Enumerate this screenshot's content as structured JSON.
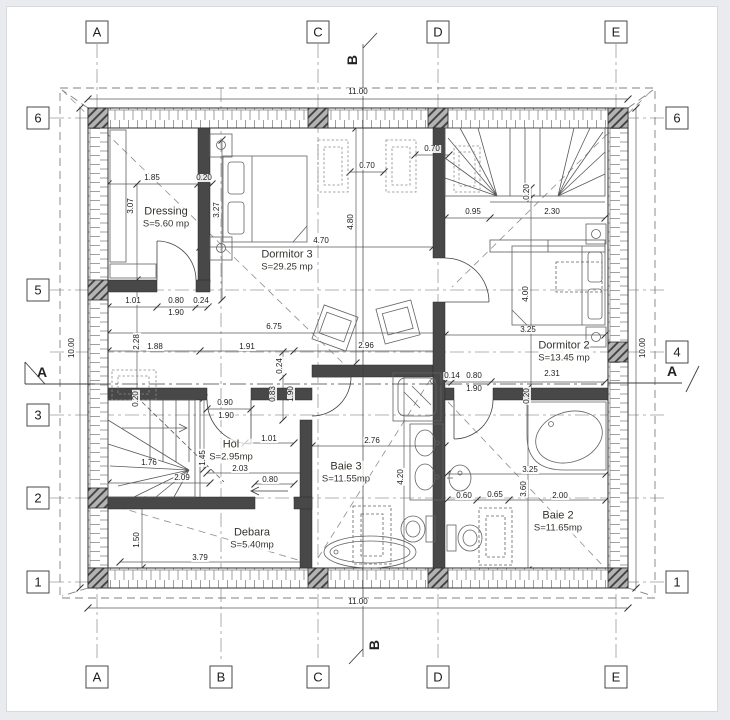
{
  "drawing": {
    "type": "floor-plan",
    "colors": {
      "paper": "#ffffff",
      "line": "#3a3a3a",
      "wall_fill": "#484848",
      "hatch": "#777777",
      "grid": "#9a9aa0"
    }
  },
  "axes": {
    "top": [
      {
        "label": "A",
        "x": 97
      },
      {
        "label": "C",
        "x": 318
      },
      {
        "label": "D",
        "x": 438
      },
      {
        "label": "E",
        "x": 616
      }
    ],
    "bottom": [
      {
        "label": "A",
        "x": 97
      },
      {
        "label": "B",
        "x": 221
      },
      {
        "label": "C",
        "x": 318
      },
      {
        "label": "D",
        "x": 438
      },
      {
        "label": "E",
        "x": 616
      }
    ],
    "left": [
      {
        "label": "6",
        "y": 118
      },
      {
        "label": "5",
        "y": 290
      },
      {
        "label": "3",
        "y": 415
      },
      {
        "label": "2",
        "y": 498
      },
      {
        "label": "1",
        "y": 582
      }
    ],
    "right": [
      {
        "label": "6",
        "y": 118
      },
      {
        "label": "4",
        "y": 352
      },
      {
        "label": "1",
        "y": 582
      }
    ],
    "sections": [
      {
        "label": "A",
        "x": 42,
        "y": 372
      },
      {
        "label": "A",
        "x": 672,
        "y": 371
      },
      {
        "label": "B",
        "x": 352,
        "y": 60,
        "r": 1
      },
      {
        "label": "B",
        "x": 374,
        "y": 645,
        "r": 1
      }
    ]
  },
  "rooms": [
    {
      "name": "Dressing",
      "area": "S=5.60 mp",
      "x": 166,
      "y": 218
    },
    {
      "name": "Dormitor 3",
      "area": "S=29.25 mp",
      "x": 287,
      "y": 261
    },
    {
      "name": "Dormitor 2",
      "area": "S=13.45 mp",
      "x": 564,
      "y": 352
    },
    {
      "name": "Hol",
      "area": "S=2.95mp",
      "x": 231,
      "y": 451
    },
    {
      "name": "Baie 3",
      "area": "S=11.55mp",
      "x": 346,
      "y": 473
    },
    {
      "name": "Debara",
      "area": "S=5.40mp",
      "x": 252,
      "y": 539
    },
    {
      "name": "Baie 2",
      "area": "S=11.65mp",
      "x": 558,
      "y": 522
    }
  ],
  "dims": [
    {
      "t": "11.00",
      "x": 358,
      "y": 92
    },
    {
      "t": "11.00",
      "x": 358,
      "y": 602
    },
    {
      "t": "10.00",
      "x": 72,
      "y": 348,
      "r": 1
    },
    {
      "t": "10.00",
      "x": 643,
      "y": 348,
      "r": 1
    },
    {
      "t": "1.85",
      "x": 152,
      "y": 178
    },
    {
      "t": "0.20",
      "x": 204,
      "y": 178
    },
    {
      "t": "3.07",
      "x": 131,
      "y": 206,
      "r": 1
    },
    {
      "t": "3.27",
      "x": 217,
      "y": 210,
      "r": 1
    },
    {
      "t": "0.70",
      "x": 367,
      "y": 166
    },
    {
      "t": "0.70",
      "x": 432,
      "y": 149
    },
    {
      "t": "4.80",
      "x": 351,
      "y": 222,
      "r": 1
    },
    {
      "t": "4.70",
      "x": 321,
      "y": 241
    },
    {
      "t": "0.95",
      "x": 473,
      "y": 212
    },
    {
      "t": "2.30",
      "x": 552,
      "y": 212
    },
    {
      "t": "0.20",
      "x": 527,
      "y": 192,
      "r": 1
    },
    {
      "t": "4.00",
      "x": 526,
      "y": 294,
      "r": 1
    },
    {
      "t": "3.25",
      "x": 528,
      "y": 330
    },
    {
      "t": "0.14",
      "x": 452,
      "y": 376
    },
    {
      "t": "0.80",
      "x": 474,
      "y": 376
    },
    {
      "t": "2.31",
      "x": 552,
      "y": 374
    },
    {
      "t": "1.90",
      "x": 474,
      "y": 389
    },
    {
      "t": "0.20",
      "x": 527,
      "y": 396,
      "r": 1
    },
    {
      "t": "1.01",
      "x": 133,
      "y": 301
    },
    {
      "t": "0.80",
      "x": 176,
      "y": 301
    },
    {
      "t": "0.24",
      "x": 201,
      "y": 301
    },
    {
      "t": "1.90",
      "x": 176,
      "y": 313
    },
    {
      "t": "2.28",
      "x": 137,
      "y": 342,
      "r": 1
    },
    {
      "t": "1.88",
      "x": 155,
      "y": 347
    },
    {
      "t": "1.91",
      "x": 247,
      "y": 347
    },
    {
      "t": "2.96",
      "x": 366,
      "y": 346
    },
    {
      "t": "6.75",
      "x": 274,
      "y": 327
    },
    {
      "t": "0.24",
      "x": 280,
      "y": 366,
      "r": 1
    },
    {
      "t": "0.83",
      "x": 273,
      "y": 394,
      "r": 1
    },
    {
      "t": "1.90",
      "x": 291,
      "y": 394,
      "r": 1
    },
    {
      "t": "0.90",
      "x": 225,
      "y": 403
    },
    {
      "t": "1.90",
      "x": 226,
      "y": 416
    },
    {
      "t": "0.20",
      "x": 136,
      "y": 399,
      "r": 1
    },
    {
      "t": "1.45",
      "x": 203,
      "y": 458,
      "r": 1
    },
    {
      "t": "1.76",
      "x": 149,
      "y": 463
    },
    {
      "t": "2.09",
      "x": 182,
      "y": 478
    },
    {
      "t": "1.01",
      "x": 269,
      "y": 439
    },
    {
      "t": "2.03",
      "x": 240,
      "y": 469
    },
    {
      "t": "0.80",
      "x": 270,
      "y": 480
    },
    {
      "t": "2.76",
      "x": 372,
      "y": 441
    },
    {
      "t": "4.20",
      "x": 401,
      "y": 477,
      "r": 1
    },
    {
      "t": "1.50",
      "x": 137,
      "y": 540,
      "r": 1
    },
    {
      "t": "3.79",
      "x": 200,
      "y": 558
    },
    {
      "t": "3.25",
      "x": 530,
      "y": 470
    },
    {
      "t": "3.60",
      "x": 524,
      "y": 489,
      "r": 1
    },
    {
      "t": "0.60",
      "x": 464,
      "y": 496
    },
    {
      "t": "0.65",
      "x": 495,
      "y": 495
    },
    {
      "t": "2.00",
      "x": 560,
      "y": 496
    }
  ]
}
